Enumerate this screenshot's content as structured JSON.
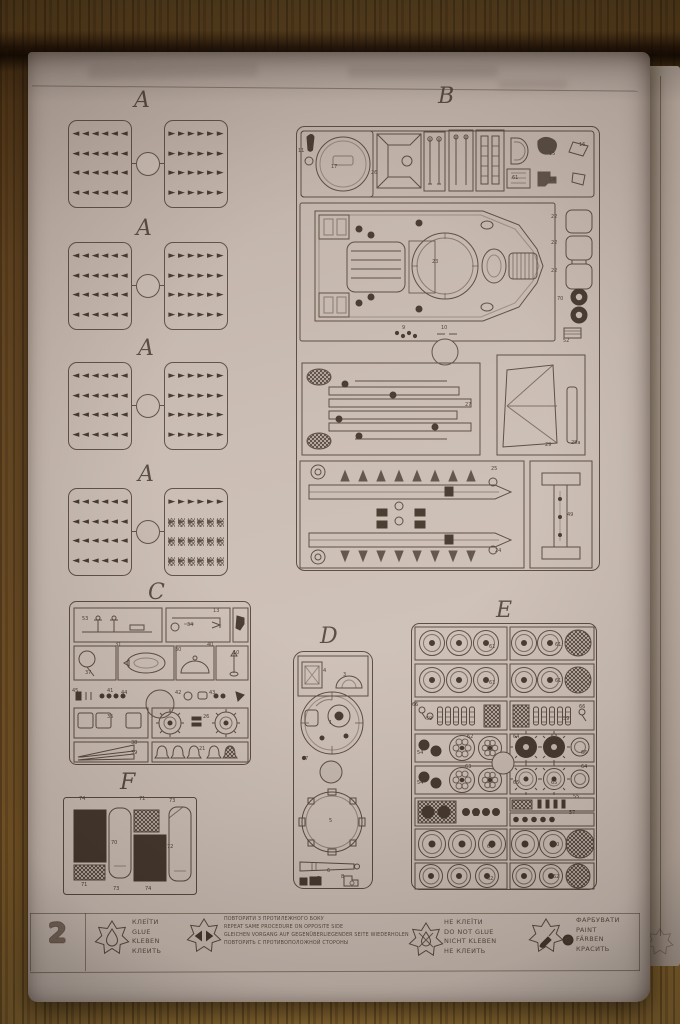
{
  "sprue_letters": {
    "a": "A",
    "b": "B",
    "c": "C",
    "d": "D",
    "e": "E",
    "f": "F"
  },
  "glyphs": {
    "left": "◄",
    "right": "►"
  },
  "a_sprues": [
    {
      "left": {
        "rows": 4,
        "cols": 6,
        "hatched_rows": []
      },
      "right": {
        "rows": 4,
        "cols": 6,
        "hatched_rows": []
      }
    },
    {
      "left": {
        "rows": 4,
        "cols": 6,
        "hatched_rows": []
      },
      "right": {
        "rows": 4,
        "cols": 6,
        "hatched_rows": []
      }
    },
    {
      "left": {
        "rows": 4,
        "cols": 6,
        "hatched_rows": []
      },
      "right": {
        "rows": 4,
        "cols": 6,
        "hatched_rows": []
      }
    },
    {
      "left": {
        "rows": 4,
        "cols": 6,
        "hatched_rows": []
      },
      "right": {
        "rows": 4,
        "cols": 6,
        "hatched_rows": [
          2,
          3,
          4
        ]
      }
    }
  ],
  "annotations": [
    [
      "11",
      270,
      97
    ],
    [
      "17",
      303,
      113
    ],
    [
      "26",
      343,
      119
    ],
    [
      "61",
      484,
      124
    ],
    [
      "15",
      521,
      100
    ],
    [
      "14",
      521,
      126
    ],
    [
      "16",
      551,
      91
    ],
    [
      "23",
      404,
      208
    ],
    [
      "22",
      523,
      163
    ],
    [
      "22",
      523,
      189
    ],
    [
      "22",
      523,
      217
    ],
    [
      "70",
      529,
      245
    ],
    [
      "52",
      535,
      287
    ],
    [
      "9",
      374,
      274
    ],
    [
      "10",
      413,
      274
    ],
    [
      "27",
      437,
      351
    ],
    [
      "29",
      517,
      391
    ],
    [
      "28a",
      543,
      389
    ],
    [
      "25",
      463,
      415
    ],
    [
      "24",
      467,
      497
    ],
    [
      "49",
      539,
      461
    ],
    [
      "53",
      54,
      565
    ],
    [
      "13",
      185,
      557
    ],
    [
      "34",
      159,
      571
    ],
    [
      "37",
      57,
      619
    ],
    [
      "31",
      87,
      591
    ],
    [
      "30",
      147,
      596
    ],
    [
      "40",
      179,
      591
    ],
    [
      "10",
      205,
      599
    ],
    [
      "45",
      44,
      637
    ],
    [
      "41",
      79,
      637
    ],
    [
      "44",
      93,
      639
    ],
    [
      "42",
      147,
      639
    ],
    [
      "43",
      181,
      639
    ],
    [
      "35",
      79,
      663
    ],
    [
      "26",
      175,
      663
    ],
    [
      "38",
      103,
      689
    ],
    [
      "39",
      103,
      699
    ],
    [
      "21",
      171,
      695
    ],
    [
      "4",
      295,
      617
    ],
    [
      "3",
      315,
      621
    ],
    [
      "1",
      301,
      669
    ],
    [
      "7",
      277,
      705
    ],
    [
      "5",
      301,
      767
    ],
    [
      "6",
      299,
      817
    ],
    [
      "5",
      289,
      825
    ],
    [
      "8",
      313,
      823
    ],
    [
      "61",
      461,
      593
    ],
    [
      "61",
      527,
      591
    ],
    [
      "61",
      461,
      629
    ],
    [
      "61",
      527,
      627
    ],
    [
      "66",
      384,
      651
    ],
    [
      "59",
      398,
      665
    ],
    [
      "59",
      535,
      665
    ],
    [
      "66",
      551,
      653
    ],
    [
      "54",
      389,
      699
    ],
    [
      "62",
      439,
      683
    ],
    [
      "64",
      485,
      683
    ],
    [
      "64",
      523,
      683
    ],
    [
      "66",
      553,
      699
    ],
    [
      "54",
      389,
      729
    ],
    [
      "63",
      437,
      713
    ],
    [
      "65",
      485,
      729
    ],
    [
      "65",
      523,
      729
    ],
    [
      "64",
      553,
      713
    ],
    [
      "56",
      445,
      761
    ],
    [
      "55",
      545,
      743
    ],
    [
      "57",
      541,
      759
    ],
    [
      "60",
      459,
      793
    ],
    [
      "60",
      525,
      791
    ],
    [
      "62",
      459,
      825
    ],
    [
      "62",
      525,
      823
    ],
    [
      "74",
      51,
      745
    ],
    [
      "71",
      111,
      745
    ],
    [
      "73",
      141,
      747
    ],
    [
      "70",
      83,
      789
    ],
    [
      "72",
      139,
      793
    ],
    [
      "71",
      53,
      831
    ],
    [
      "73",
      85,
      835
    ],
    [
      "74",
      117,
      835
    ]
  ],
  "legend": {
    "page_number": "2",
    "items": [
      {
        "icon": "glue-icon",
        "lines": [
          "КЛЕЇТИ",
          "GLUE",
          "KLEBEN",
          "КЛЕИТЬ"
        ]
      },
      {
        "icon": "repeat-icon",
        "lines": [
          "ПОВТОРИТИ З ПРОТИЛЕЖНОГО БОКУ",
          "REPEAT SAME PROCEDURE ON OPPOSITE SIDE",
          "GLEICHEN VORGANG AUF GEGENÜBERLIEGENDER SEITE WIEDERHOLEN",
          "ПОВТОРИТЬ С ПРОТИВОПОЛОЖНОЙ СТОРОНЫ"
        ]
      },
      {
        "icon": "no-glue-icon",
        "lines": [
          "НЕ КЛЕЇТИ",
          "DO NOT GLUE",
          "NICHT KLEBEN",
          "НЕ КЛЕИТЬ"
        ]
      },
      {
        "icon": "paint-icon",
        "lines": [
          "ФАРБУВАТИ",
          "PAINT",
          "FÄRBEN",
          "КРАСИТЬ"
        ]
      }
    ]
  },
  "colors": {
    "paper": "#cabdb4",
    "ink": "#584a3f",
    "dark_part": "#44382e",
    "wood": "#6e4e24"
  }
}
